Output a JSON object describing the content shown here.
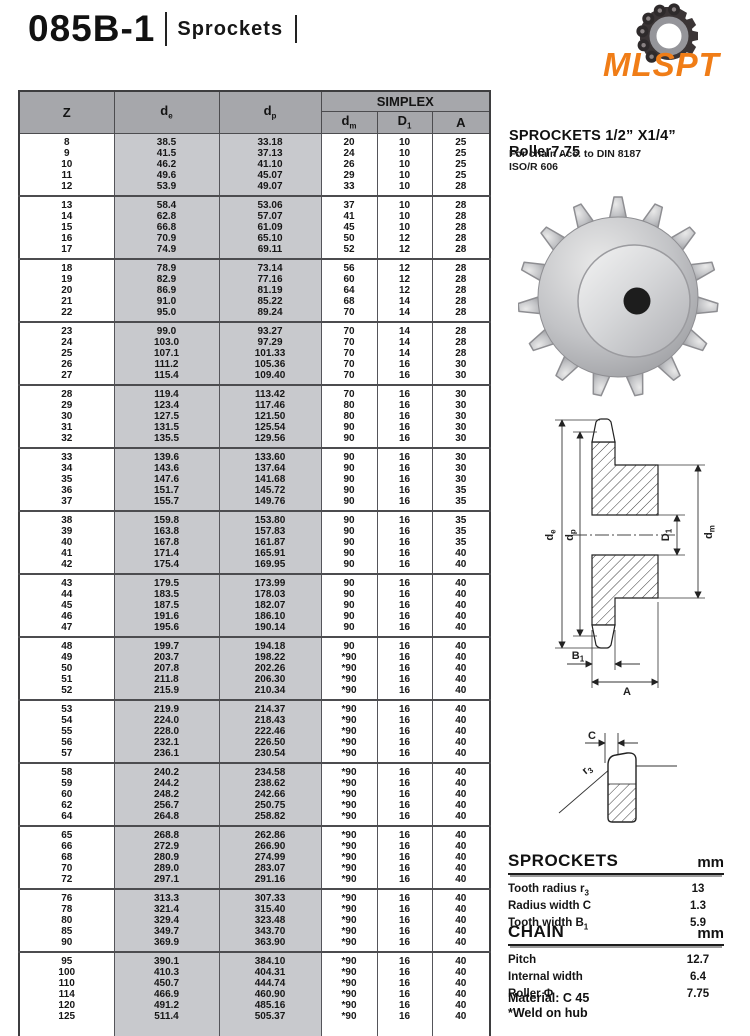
{
  "header": {
    "model": "085B-1",
    "category": "Sprockets"
  },
  "logo": {
    "brand": "MLSPT",
    "accent_color": "#f07d17"
  },
  "product": {
    "title": "SPROCKETS 1/2”  X1/4”  Roller7.75",
    "standard_line1": "For chain Acc. to DIN 8187",
    "standard_line2": "ISO/R 606"
  },
  "table": {
    "header": {
      "z": "Z",
      "de": {
        "main": "d",
        "sub": "e"
      },
      "dp": {
        "main": "d",
        "sub": "p"
      },
      "simplex": "SIMPLEX",
      "dm": {
        "main": "d",
        "sub": "m"
      },
      "d1": {
        "main": "D",
        "sub": "1"
      },
      "a": "A"
    },
    "groups": [
      {
        "rows": [
          [
            "8",
            "38.5",
            "33.18",
            "20",
            "10",
            "25"
          ],
          [
            "9",
            "41.5",
            "37.13",
            "24",
            "10",
            "25"
          ],
          [
            "10",
            "46.2",
            "41.10",
            "26",
            "10",
            "25"
          ],
          [
            "11",
            "49.6",
            "45.07",
            "29",
            "10",
            "25"
          ],
          [
            "12",
            "53.9",
            "49.07",
            "33",
            "10",
            "28"
          ]
        ]
      },
      {
        "rows": [
          [
            "13",
            "58.4",
            "53.06",
            "37",
            "10",
            "28"
          ],
          [
            "14",
            "62.8",
            "57.07",
            "41",
            "10",
            "28"
          ],
          [
            "15",
            "66.8",
            "61.09",
            "45",
            "10",
            "28"
          ],
          [
            "16",
            "70.9",
            "65.10",
            "50",
            "12",
            "28"
          ],
          [
            "17",
            "74.9",
            "69.11",
            "52",
            "12",
            "28"
          ]
        ]
      },
      {
        "rows": [
          [
            "18",
            "78.9",
            "73.14",
            "56",
            "12",
            "28"
          ],
          [
            "19",
            "82.9",
            "77.16",
            "60",
            "12",
            "28"
          ],
          [
            "20",
            "86.9",
            "81.19",
            "64",
            "12",
            "28"
          ],
          [
            "21",
            "91.0",
            "85.22",
            "68",
            "14",
            "28"
          ],
          [
            "22",
            "95.0",
            "89.24",
            "70",
            "14",
            "28"
          ]
        ]
      },
      {
        "rows": [
          [
            "23",
            "99.0",
            "93.27",
            "70",
            "14",
            "28"
          ],
          [
            "24",
            "103.0",
            "97.29",
            "70",
            "14",
            "28"
          ],
          [
            "25",
            "107.1",
            "101.33",
            "70",
            "14",
            "28"
          ],
          [
            "26",
            "111.2",
            "105.36",
            "70",
            "16",
            "30"
          ],
          [
            "27",
            "115.4",
            "109.40",
            "70",
            "16",
            "30"
          ]
        ]
      },
      {
        "rows": [
          [
            "28",
            "119.4",
            "113.42",
            "70",
            "16",
            "30"
          ],
          [
            "29",
            "123.4",
            "117.46",
            "80",
            "16",
            "30"
          ],
          [
            "30",
            "127.5",
            "121.50",
            "80",
            "16",
            "30"
          ],
          [
            "31",
            "131.5",
            "125.54",
            "90",
            "16",
            "30"
          ],
          [
            "32",
            "135.5",
            "129.56",
            "90",
            "16",
            "30"
          ]
        ]
      },
      {
        "rows": [
          [
            "33",
            "139.6",
            "133.60",
            "90",
            "16",
            "30"
          ],
          [
            "34",
            "143.6",
            "137.64",
            "90",
            "16",
            "30"
          ],
          [
            "35",
            "147.6",
            "141.68",
            "90",
            "16",
            "30"
          ],
          [
            "36",
            "151.7",
            "145.72",
            "90",
            "16",
            "35"
          ],
          [
            "37",
            "155.7",
            "149.76",
            "90",
            "16",
            "35"
          ]
        ]
      },
      {
        "rows": [
          [
            "38",
            "159.8",
            "153.80",
            "90",
            "16",
            "35"
          ],
          [
            "39",
            "163.8",
            "157.83",
            "90",
            "16",
            "35"
          ],
          [
            "40",
            "167.8",
            "161.87",
            "90",
            "16",
            "35"
          ],
          [
            "41",
            "171.4",
            "165.91",
            "90",
            "16",
            "40"
          ],
          [
            "42",
            "175.4",
            "169.95",
            "90",
            "16",
            "40"
          ]
        ]
      },
      {
        "rows": [
          [
            "43",
            "179.5",
            "173.99",
            "90",
            "16",
            "40"
          ],
          [
            "44",
            "183.5",
            "178.03",
            "90",
            "16",
            "40"
          ],
          [
            "45",
            "187.5",
            "182.07",
            "90",
            "16",
            "40"
          ],
          [
            "46",
            "191.6",
            "186.10",
            "90",
            "16",
            "40"
          ],
          [
            "47",
            "195.6",
            "190.14",
            "90",
            "16",
            "40"
          ]
        ]
      },
      {
        "rows": [
          [
            "48",
            "199.7",
            "194.18",
            "90",
            "16",
            "40"
          ],
          [
            "49",
            "203.7",
            "198.22",
            "*90",
            "16",
            "40"
          ],
          [
            "50",
            "207.8",
            "202.26",
            "*90",
            "16",
            "40"
          ],
          [
            "51",
            "211.8",
            "206.30",
            "*90",
            "16",
            "40"
          ],
          [
            "52",
            "215.9",
            "210.34",
            "*90",
            "16",
            "40"
          ]
        ]
      },
      {
        "rows": [
          [
            "53",
            "219.9",
            "214.37",
            "*90",
            "16",
            "40"
          ],
          [
            "54",
            "224.0",
            "218.43",
            "*90",
            "16",
            "40"
          ],
          [
            "55",
            "228.0",
            "222.46",
            "*90",
            "16",
            "40"
          ],
          [
            "56",
            "232.1",
            "226.50",
            "*90",
            "16",
            "40"
          ],
          [
            "57",
            "236.1",
            "230.54",
            "*90",
            "16",
            "40"
          ]
        ]
      },
      {
        "rows": [
          [
            "58",
            "240.2",
            "234.58",
            "*90",
            "16",
            "40"
          ],
          [
            "59",
            "244.2",
            "238.62",
            "*90",
            "16",
            "40"
          ],
          [
            "60",
            "248.2",
            "242.66",
            "*90",
            "16",
            "40"
          ],
          [
            "62",
            "256.7",
            "250.75",
            "*90",
            "16",
            "40"
          ],
          [
            "64",
            "264.8",
            "258.82",
            "*90",
            "16",
            "40"
          ]
        ]
      },
      {
        "rows": [
          [
            "65",
            "268.8",
            "262.86",
            "*90",
            "16",
            "40"
          ],
          [
            "66",
            "272.9",
            "266.90",
            "*90",
            "16",
            "40"
          ],
          [
            "68",
            "280.9",
            "274.99",
            "*90",
            "16",
            "40"
          ],
          [
            "70",
            "289.0",
            "283.07",
            "*90",
            "16",
            "40"
          ],
          [
            "72",
            "297.1",
            "291.16",
            "*90",
            "16",
            "40"
          ]
        ]
      },
      {
        "rows": [
          [
            "76",
            "313.3",
            "307.33",
            "*90",
            "16",
            "40"
          ],
          [
            "78",
            "321.4",
            "315.40",
            "*90",
            "16",
            "40"
          ],
          [
            "80",
            "329.4",
            "323.48",
            "*90",
            "16",
            "40"
          ],
          [
            "85",
            "349.7",
            "343.70",
            "*90",
            "16",
            "40"
          ],
          [
            "90",
            "369.9",
            "363.90",
            "*90",
            "16",
            "40"
          ]
        ]
      },
      {
        "rows": [
          [
            "95",
            "390.1",
            "384.10",
            "*90",
            "16",
            "40"
          ],
          [
            "100",
            "410.3",
            "404.31",
            "*90",
            "16",
            "40"
          ],
          [
            "110",
            "450.7",
            "444.74",
            "*90",
            "16",
            "40"
          ],
          [
            "114",
            "466.9",
            "460.90",
            "*90",
            "16",
            "40"
          ],
          [
            "120",
            "491.2",
            "485.16",
            "*90",
            "16",
            "40"
          ],
          [
            "125",
            "511.4",
            "505.37",
            "*90",
            "16",
            "40"
          ]
        ]
      }
    ]
  },
  "drawing": {
    "labels": {
      "de": {
        "main": "d",
        "sub": "e"
      },
      "dp": {
        "main": "d",
        "sub": "p"
      },
      "d1": {
        "main": "D",
        "sub": "1"
      },
      "dm": {
        "main": "d",
        "sub": "m"
      },
      "b1": {
        "main": "B",
        "sub": "1"
      },
      "a": "A"
    }
  },
  "tooth": {
    "labels": {
      "c": "C",
      "r3": {
        "main": "r",
        "sub": "3"
      }
    }
  },
  "specs": {
    "sprockets": {
      "heading": "SPROCKETS",
      "unit": "mm",
      "rows": [
        {
          "label": "Tooth radius r",
          "label_sub": "3",
          "value": "13"
        },
        {
          "label": "Radius width C",
          "label_sub": "",
          "value": "1.3"
        },
        {
          "label": "Tooth width B",
          "label_sub": "1",
          "value": "5.9"
        }
      ]
    },
    "chain": {
      "heading": "CHAIN",
      "unit": "mm",
      "rows": [
        {
          "label": "Pitch",
          "label_sub": "",
          "value": "12.7"
        },
        {
          "label": "Internal width",
          "label_sub": "",
          "value": "6.4"
        },
        {
          "label": "Roller Φ",
          "label_sub": "",
          "value": "7.75"
        }
      ]
    },
    "material": "Material: C 45",
    "weld_note": "*Weld on hub"
  }
}
